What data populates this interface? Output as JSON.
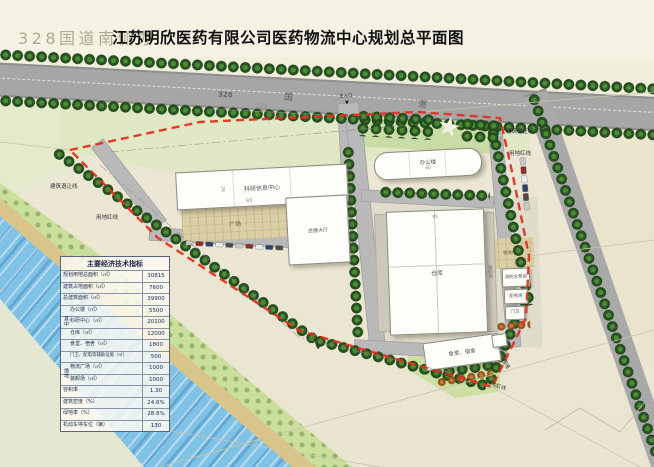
{
  "title": {
    "watermark": "328国道南侧办",
    "main": "江苏明欣医药有限公司医药物流中心规划总平面图"
  },
  "road": {
    "number": "328",
    "guo": "国",
    "dao": "道",
    "dim": "270",
    "entrance_label": "主入口",
    "entrance_marker": "▼"
  },
  "boundary": {
    "setback_left": "建筑退让线",
    "redline_left": "用地红线",
    "setback_right": "建筑退让线",
    "redline_right": "用地红线",
    "wall": "围墙",
    "redline_bottom": "用地红线"
  },
  "buildings": {
    "research": {
      "label": "科研信息中心",
      "dim_length": "93",
      "dim_width": "26"
    },
    "hall": {
      "label": "会展大厅"
    },
    "office": {
      "label": "办公楼",
      "dim": "60"
    },
    "warehouse": {
      "label": "仓库",
      "dim": "95"
    },
    "canteen": {
      "label": "食堂、宿舍"
    },
    "pump": {
      "label": "消防水泵房"
    },
    "power": {
      "label": "配电房"
    },
    "guard": {
      "label": "门卫"
    },
    "plaza": {
      "label": "广场"
    },
    "logistics_plaza": {
      "label": "物流广场"
    },
    "loading": {
      "label": "装卸场"
    }
  },
  "table": {
    "header": "主要经济技术指标",
    "group_a": "其中",
    "group_b": "场地",
    "rows": [
      {
        "label": "规划用地总面积（㎡）",
        "value": "30815"
      },
      {
        "label": "建筑占地面积（㎡）",
        "value": "7600"
      },
      {
        "label": "总建筑面积（㎡）",
        "value": "39900"
      },
      {
        "label": "办公楼（㎡）",
        "value": "5500"
      },
      {
        "label": "科研中心（㎡）",
        "value": "20100"
      },
      {
        "label": "仓库（㎡）",
        "value": "12000"
      },
      {
        "label": "食堂、宿舍（㎡）",
        "value": "1800"
      },
      {
        "label": "门卫、配电等辅助设施（㎡）",
        "value": "500"
      },
      {
        "label": "物流广场（㎡）",
        "value": "1000"
      },
      {
        "label": "装卸场（㎡）",
        "value": "1000"
      },
      {
        "label": "容积率",
        "value": "1.30"
      },
      {
        "label": "建筑密度（%）",
        "value": "24.6%"
      },
      {
        "label": "绿地率（%）",
        "value": "28.8%"
      },
      {
        "label": "机动车停车位（辆）",
        "value": "130"
      }
    ]
  }
}
